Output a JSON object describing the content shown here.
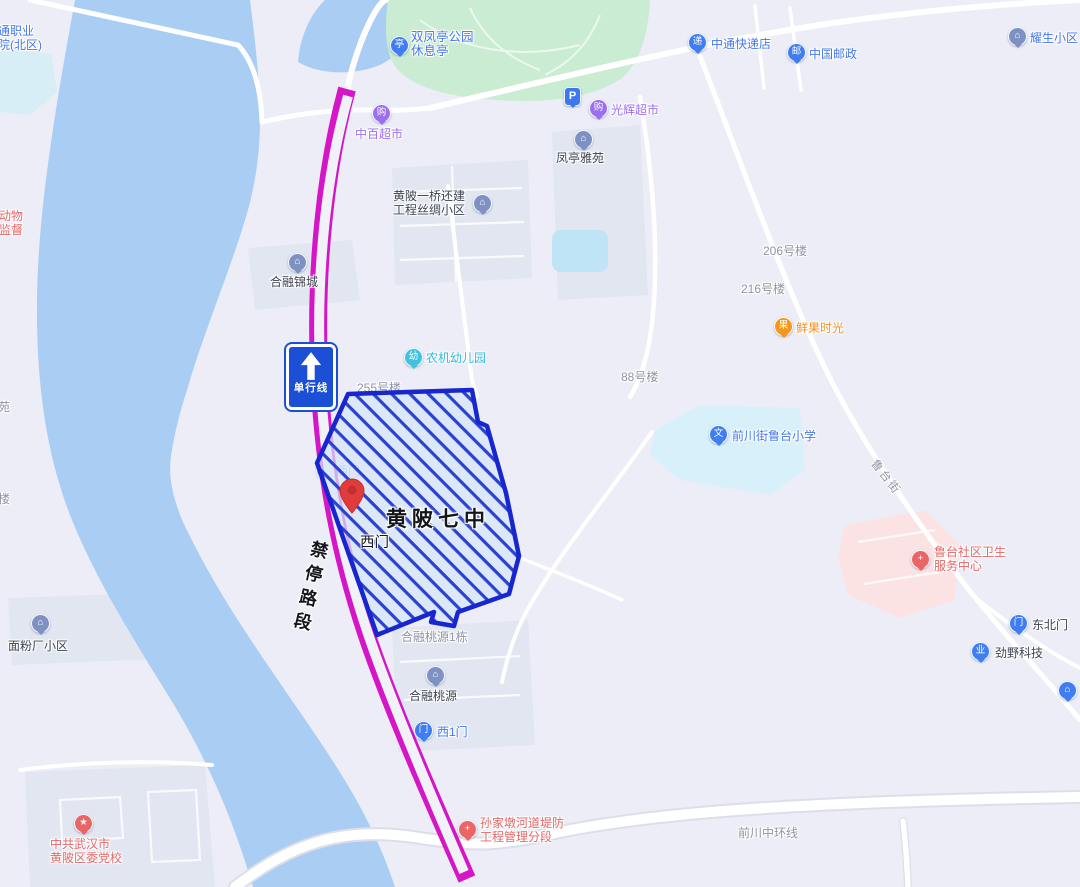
{
  "colors": {
    "land": "#ecedf6",
    "block": "#e2e6f1",
    "water": "#a9cdf3",
    "pond": "#bfe4f6",
    "park": "#c9ecd3",
    "cyan_zone": "#d8f0fa",
    "pink_zone": "#fbe3e4",
    "road": "#ffffff",
    "road_casing": "#dcdfe9",
    "magenta": "#d416c6",
    "polygon_border": "#1726cf",
    "polygon_stripe": "#2b41cf",
    "polygon_fill": "#d6e6fa",
    "sign_blue": "#1a4fd6",
    "pin_red": "#e13b3b",
    "poi_blue": "#3f7df0",
    "poi_pblue": "#3d78ee",
    "poi_slate": "#7d92c2",
    "poi_purple": "#9d6ff0",
    "poi_cyan": "#41c3e0",
    "poi_orange": "#f5971f",
    "poi_red": "#e96666",
    "text_blue": "#4478e8",
    "text_purple": "#9d6ff0",
    "text_cyan": "#36b7dc",
    "text_orange": "#f09228",
    "text_red": "#e06868",
    "text_gray": "#8e94a3",
    "text_dark": "#3d4350",
    "text_black": "#14161c"
  },
  "overlay": {
    "school_name": "黄陂七中",
    "west_gate": "西门",
    "no_stop": "禁停路段"
  },
  "sign": {
    "one_way": "单行线"
  },
  "pois": {
    "college": {
      "line1": "通职业",
      "line2": "院(北区)"
    },
    "park": {
      "glyph": "亭",
      "line1": "双凤亭公园",
      "line2": "休息亭"
    },
    "zhongbai": {
      "glyph": "购",
      "name": "中百超市"
    },
    "parking": {
      "glyph": "P"
    },
    "guanghui": {
      "glyph": "购",
      "name": "光辉超市"
    },
    "fengting": {
      "glyph": "⌂",
      "name": "凤亭雅苑"
    },
    "zhongtong": {
      "glyph": "递",
      "name": "中通快递店"
    },
    "post": {
      "glyph": "邮",
      "name": "中国邮政"
    },
    "yaosheng": {
      "glyph": "⌂",
      "name": "耀生小区"
    },
    "sichou": {
      "glyph": "⌂",
      "line1": "黄陂一桥还建",
      "line2": "工程丝绸小区"
    },
    "bldg206": {
      "name": "206号楼"
    },
    "bldg216": {
      "name": "216号楼"
    },
    "bldg255": {
      "name": "255号楼"
    },
    "bldg88": {
      "name": "88号楼"
    },
    "xianguo": {
      "glyph": "果",
      "name": "鲜果时光"
    },
    "herongjincheng": {
      "glyph": "⌂",
      "name": "合融锦城"
    },
    "nongji": {
      "glyph": "幼",
      "name": "农机幼儿园"
    },
    "lutaischool": {
      "glyph": "文",
      "name": "前川街鲁台小学"
    },
    "lutaistreet": {
      "name": "鲁台街"
    },
    "health": {
      "glyph": "+",
      "line1": "鲁台社区卫生",
      "line2": "服务中心"
    },
    "dongbeimen": {
      "glyph": "门",
      "name": "东北门"
    },
    "jinye": {
      "glyph": "业",
      "name": "劲野科技"
    },
    "partial": {
      "glyph": "⌂"
    },
    "taoyuan1": {
      "name": "合融桃源1栋"
    },
    "herongtaoyuan": {
      "glyph": "⌂",
      "name": "合融桃源"
    },
    "xi1men": {
      "glyph": "门",
      "name": "西1门"
    },
    "ximen_gate": {
      "glyph": "门",
      "name": "西门"
    },
    "mianfen": {
      "glyph": "⌂",
      "name": "面粉厂小区"
    },
    "sunjia": {
      "glyph": "+",
      "line1": "孙家墩河道堤防",
      "line2": "工程管理分段"
    },
    "qianchuan": {
      "name": "前川中环线"
    },
    "dangxiao": {
      "glyph": "★",
      "line1": "中共武汉市",
      "line2": "黄陂区委党校"
    },
    "animal": {
      "line1": "动物",
      "line2": "监督"
    },
    "yuan": {
      "name": "苑"
    },
    "lou": {
      "name": "楼"
    }
  }
}
